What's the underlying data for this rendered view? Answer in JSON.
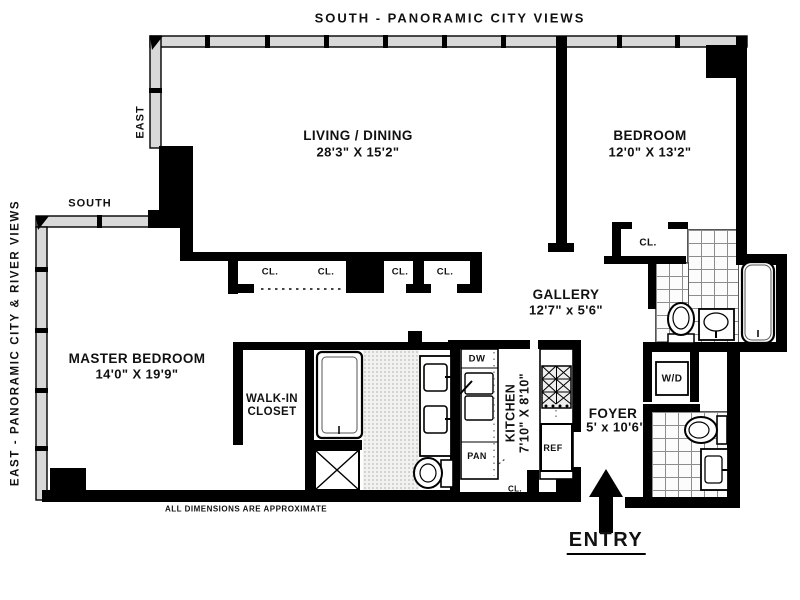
{
  "plan": {
    "exposures": {
      "top": "SOUTH - PANORAMIC CITY VIEWS",
      "left": "EAST - PANORAMIC CITY & RIVER VIEWS",
      "east": "EAST",
      "south": "SOUTH"
    },
    "rooms": {
      "living_dining": {
        "name": "LIVING / DINING",
        "dims": "28'3\" X 15'2\""
      },
      "bedroom": {
        "name": "BEDROOM",
        "dims": "12'0\" X 13'2\""
      },
      "master_bedroom": {
        "name": "MASTER BEDROOM",
        "dims": "14'0\" X 19'9\""
      },
      "walk_in_closet": {
        "line1": "WALK-IN",
        "line2": "CLOSET"
      },
      "gallery": {
        "name": "GALLERY",
        "dims": "12'7\" x 5'6\""
      },
      "kitchen": {
        "name": "KITCHEN",
        "dims": "7'10\" X 8'10\""
      },
      "foyer": {
        "name": "FOYER",
        "dims": "5' x 10'6\""
      }
    },
    "closets": {
      "cl": "CL."
    },
    "appliances": {
      "dw": "DW",
      "pan": "PAN",
      "ref": "REF",
      "wd": "W/D"
    },
    "entry": "ENTRY",
    "disclaimer": "ALL  DIMENSIONS  ARE  APPROXIMATE",
    "colors": {
      "wall": "#000000",
      "window_band": "#d9d9d9",
      "background": "#ffffff"
    }
  }
}
